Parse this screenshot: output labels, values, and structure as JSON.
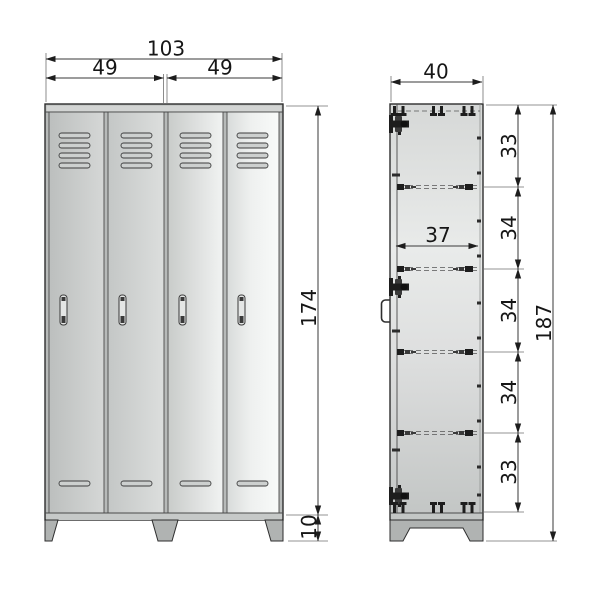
{
  "front_view": {
    "dim_total_width": "103",
    "dim_left_section_width": "49",
    "dim_right_section_width": "49",
    "dim_cabinet_height": "174",
    "dim_leg_height": "10"
  },
  "side_view": {
    "dim_depth": "40",
    "dim_inner_depth": "37",
    "dim_compartment_heights": [
      "33",
      "34",
      "34",
      "34",
      "33"
    ],
    "dim_total_height": "187"
  },
  "colors": {
    "line": "#2e2e2e",
    "dimension_text": "#161616",
    "metal_light": "#eef0ef",
    "metal_mid": "#cfd2d1",
    "metal_dark": "#b0b3b2",
    "background": "#ffffff"
  }
}
